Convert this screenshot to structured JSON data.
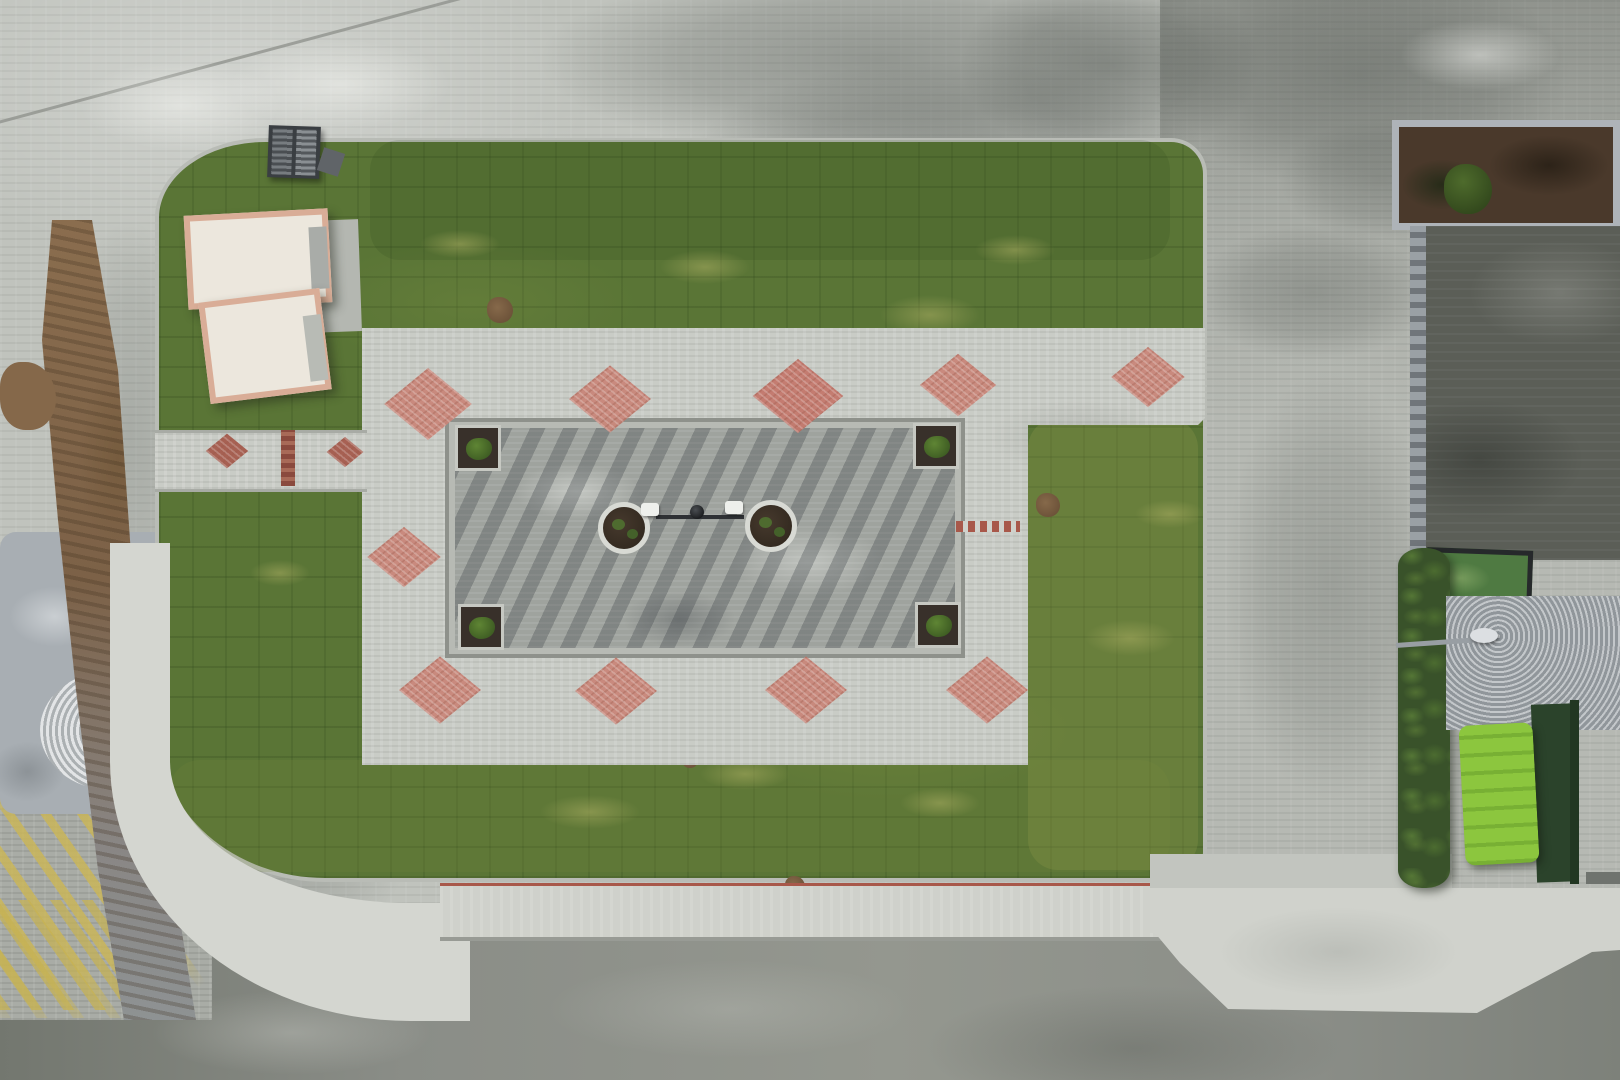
{
  "scene": {
    "type": "aerial-drone-photograph",
    "description": "Top-down drone view of a newly landscaped pocket park with a central outdoor fitness plaza, red exercise equipment, pink diamond paving accents, wooden benches, lawns of fresh sod, surrounding paver plazas, parked cars along three sides, a ramp with yellow arrows at top right, palm trees, a green utility container, and streets with sidewalks"
  },
  "palette": {
    "grass": "#5a7536",
    "pavement": "#c0c3bd",
    "plaza": "#c9ccc6",
    "fitness_pavement": "#9fa39e",
    "asphalt": "#8b8e88",
    "sidewalk": "#d4d6d0",
    "accent_red": "#a8584a",
    "diamond_pink": "#c98578",
    "equipment_red": "#e8472e",
    "bench_wood": "#b5762f",
    "hedge_green": "#39522a",
    "container_green": "#8cc63e",
    "tactile_yellow": "#cbb655",
    "mud_brown": "#8a6d4e",
    "ramp_yellow": "#c8b33e"
  },
  "objects": {
    "cars": [
      {
        "name": "car-top-silver-roof",
        "x": 681,
        "y": 97,
        "w": 108,
        "h": 55,
        "rot": -2,
        "o": "h",
        "body": "#3c4046",
        "glass": "#1e2125",
        "roof": "#c3c8cc"
      },
      {
        "name": "car-top-red",
        "x": 814,
        "y": 88,
        "w": 102,
        "h": 62,
        "rot": 2,
        "o": "h",
        "body": "#c0182a",
        "glass": "#26222e",
        "roof": null
      },
      {
        "name": "car-top-black",
        "x": 933,
        "y": 92,
        "w": 108,
        "h": 60,
        "rot": 1,
        "o": "h",
        "body": "#1a1d21",
        "glass": "#0e1013",
        "roof": "#2e3237"
      },
      {
        "name": "suv-top-right-white",
        "x": 1428,
        "y": 94,
        "w": 120,
        "h": 62,
        "rot": -1,
        "o": "h",
        "body": "#e9ebe9",
        "glass": "#2a2d33",
        "roof": "#c9cdd1"
      },
      {
        "name": "car-east-black",
        "x": 1206,
        "y": 186,
        "w": 62,
        "h": 116,
        "rot": 2,
        "o": "v",
        "body": "#1b1e22",
        "glass": "#0f1114",
        "roof": "#878d94"
      },
      {
        "name": "car-east-white-1",
        "x": 1209,
        "y": 451,
        "w": 60,
        "h": 114,
        "rot": 1,
        "o": "v",
        "body": "#e7e9e7",
        "glass": "#30343a",
        "roof": null
      },
      {
        "name": "car-east-darkblue",
        "x": 1206,
        "y": 586,
        "w": 64,
        "h": 125,
        "rot": 1,
        "o": "v",
        "body": "#27334e",
        "glass": "#12161f",
        "roof": "#3c4a68"
      },
      {
        "name": "car-east-maroon",
        "x": 1348,
        "y": 602,
        "w": 62,
        "h": 120,
        "rot": -2,
        "o": "v",
        "body": "#8e1e2c",
        "glass": "#1a161c",
        "roof": null
      },
      {
        "name": "car-east-white-2",
        "x": 1217,
        "y": 732,
        "w": 58,
        "h": 124,
        "rot": 2,
        "o": "v",
        "body": "#e8eae8",
        "glass": "#2e3237",
        "roof": null
      },
      {
        "name": "car-east-white-3",
        "x": 1363,
        "y": 744,
        "w": 63,
        "h": 120,
        "rot": -1,
        "o": "v",
        "body": "#eceeec",
        "glass": "#2b2f34",
        "roof": null
      },
      {
        "name": "car-south-white-1",
        "x": 447,
        "y": 963,
        "w": 128,
        "h": 62,
        "rot": -7,
        "o": "h",
        "body": "#e9ebe9",
        "glass": "#2c3036",
        "roof": null
      },
      {
        "name": "car-south-black",
        "x": 588,
        "y": 953,
        "w": 132,
        "h": 66,
        "rot": -2,
        "o": "h",
        "body": "#15171b",
        "glass": "#090a0c",
        "roof": null
      },
      {
        "name": "car-south-silver",
        "x": 856,
        "y": 940,
        "w": 132,
        "h": 62,
        "rot": -1,
        "o": "h",
        "body": "#dfe3e2",
        "glass": "#23272c",
        "roof": null
      },
      {
        "name": "car-south-white-2",
        "x": 1012,
        "y": 935,
        "w": 124,
        "h": 62,
        "rot": 1,
        "o": "h",
        "body": "#e9ebe9",
        "glass": "#272b30",
        "roof": null
      }
    ],
    "trees": [
      {
        "x": 349,
        "y": 161,
        "r": 23,
        "tone": "mid"
      },
      {
        "x": 303,
        "y": 152,
        "r": 11,
        "tone": "mid"
      },
      {
        "x": 718,
        "y": 182,
        "r": 28,
        "tone": "mid"
      },
      {
        "x": 757,
        "y": 198,
        "r": 14,
        "tone": "mid"
      },
      {
        "x": 1083,
        "y": 197,
        "r": 32,
        "tone": "mid"
      },
      {
        "x": 1120,
        "y": 228,
        "r": 16,
        "tone": "dark"
      },
      {
        "x": 1164,
        "y": 270,
        "r": 40,
        "tone": "dark"
      },
      {
        "x": 1146,
        "y": 315,
        "r": 22,
        "tone": "dark"
      },
      {
        "x": 1068,
        "y": 512,
        "r": 22,
        "tone": "bright"
      },
      {
        "x": 1225,
        "y": 668,
        "r": 26,
        "tone": "mid"
      },
      {
        "x": 270,
        "y": 838,
        "r": 22,
        "tone": "mid"
      },
      {
        "x": 350,
        "y": 846,
        "r": 20,
        "tone": "mid"
      },
      {
        "x": 298,
        "y": 898,
        "r": 20,
        "tone": "mid"
      },
      {
        "x": 388,
        "y": 903,
        "r": 16,
        "tone": "mid"
      },
      {
        "x": 518,
        "y": 897,
        "r": 24,
        "tone": "mid"
      },
      {
        "x": 566,
        "y": 890,
        "r": 13,
        "tone": "bright"
      },
      {
        "x": 786,
        "y": 901,
        "r": 23,
        "tone": "mid"
      },
      {
        "x": 1000,
        "y": 907,
        "r": 28,
        "tone": "mid"
      },
      {
        "x": 1048,
        "y": 917,
        "r": 16,
        "tone": "mid"
      },
      {
        "x": 1152,
        "y": 899,
        "r": 26,
        "tone": "mid"
      },
      {
        "x": 609,
        "y": 921,
        "r": 12,
        "tone": "bright"
      }
    ],
    "palms": [
      {
        "x": 1552,
        "y": 138,
        "r": 95
      },
      {
        "x": 1618,
        "y": 205,
        "r": 70
      },
      {
        "x": 1582,
        "y": 652,
        "r": 82
      },
      {
        "x": 1548,
        "y": 586,
        "r": 40
      }
    ],
    "bush_rows": [
      {
        "x1": 390,
        "y1": 172,
        "x2": 1165,
        "y2": 172,
        "count": 27,
        "r": 8
      },
      {
        "x1": 198,
        "y1": 860,
        "x2": 1135,
        "y2": 864,
        "count": 30,
        "r": 7
      },
      {
        "x1": 152,
        "y1": 565,
        "x2": 152,
        "y2": 845,
        "count": 8,
        "r": 6
      },
      {
        "x1": 185,
        "y1": 208,
        "x2": 330,
        "y2": 170,
        "count": 5,
        "r": 7
      },
      {
        "x1": 1185,
        "y1": 450,
        "x2": 1200,
        "y2": 580,
        "count": 5,
        "r": 6
      }
    ],
    "equipment": [
      {
        "type": "seats3",
        "x": 568,
        "y": 468
      },
      {
        "type": "walker",
        "x": 700,
        "y": 464
      },
      {
        "type": "rider",
        "x": 833,
        "y": 468
      },
      {
        "type": "chair",
        "x": 516,
        "y": 538
      },
      {
        "type": "spinner",
        "x": 915,
        "y": 539
      },
      {
        "type": "spinner",
        "x": 577,
        "y": 592
      },
      {
        "type": "ladder",
        "x": 706,
        "y": 586
      },
      {
        "type": "rider",
        "x": 837,
        "y": 585
      }
    ],
    "circle_planters": [
      {
        "x": 624,
        "y": 528
      },
      {
        "x": 771,
        "y": 526
      }
    ],
    "center_bar": {
      "x1": 656,
      "x2": 744,
      "y": 517,
      "pads": [
        {
          "x": 650,
          "y": 509
        },
        {
          "x": 734,
          "y": 507
        }
      ],
      "hub": {
        "x": 697,
        "y": 512
      }
    },
    "corner_planters": [
      {
        "x": 455,
        "y": 425
      },
      {
        "x": 913,
        "y": 423
      },
      {
        "x": 458,
        "y": 604
      },
      {
        "x": 915,
        "y": 602
      }
    ],
    "ball_lamps": [
      {
        "x": 370,
        "y": 363
      },
      {
        "x": 1009,
        "y": 345
      },
      {
        "x": 372,
        "y": 710
      },
      {
        "x": 1005,
        "y": 707
      }
    ],
    "benches": [
      {
        "x": 400,
        "y": 349
      },
      {
        "x": 512,
        "y": 361
      },
      {
        "x": 704,
        "y": 361
      },
      {
        "x": 876,
        "y": 357
      },
      {
        "x": 528,
        "y": 728
      },
      {
        "x": 713,
        "y": 728
      },
      {
        "x": 895,
        "y": 726
      }
    ],
    "diamonds": [
      {
        "x": 428,
        "y": 404,
        "s": 62
      },
      {
        "x": 610,
        "y": 399,
        "s": 58
      },
      {
        "x": 798,
        "y": 396,
        "s": 64,
        "solid": true
      },
      {
        "x": 958,
        "y": 385,
        "s": 54
      },
      {
        "x": 1148,
        "y": 377,
        "s": 52
      },
      {
        "x": 404,
        "y": 557,
        "s": 52
      },
      {
        "x": 440,
        "y": 690,
        "s": 58
      },
      {
        "x": 616,
        "y": 691,
        "s": 58
      },
      {
        "x": 806,
        "y": 690,
        "s": 58
      },
      {
        "x": 987,
        "y": 690,
        "s": 58
      },
      {
        "x": 227,
        "y": 451,
        "s": 30,
        "dark": true
      },
      {
        "x": 345,
        "y": 452,
        "s": 26,
        "dark": true
      }
    ],
    "plaza_red_dashline": {
      "x": 956,
      "y": 521,
      "w": 64,
      "h": 11
    },
    "crosswalk_strips_south": {
      "y": 888,
      "w": 15,
      "h": 47,
      "xs": [
        487,
        569,
        658,
        743,
        827,
        914,
        996,
        1086
      ]
    },
    "apron_strips": [
      {
        "x": 240,
        "y": 905,
        "w": 16,
        "h": 100
      },
      {
        "x": 318,
        "y": 906,
        "w": 16,
        "h": 112
      },
      {
        "x": 400,
        "y": 903,
        "w": 16,
        "h": 104
      },
      {
        "x": 1459,
        "y": 891,
        "w": 13,
        "h": 120
      },
      {
        "x": 1538,
        "y": 891,
        "w": 13,
        "h": 108
      },
      {
        "x": 1602,
        "y": 891,
        "w": 13,
        "h": 60
      },
      {
        "x": 1150,
        "y": 891,
        "w": 12,
        "h": 60
      }
    ],
    "curve_bars": [
      {
        "x": 117,
        "y": 577,
        "rot": 2
      },
      {
        "x": 126,
        "y": 677,
        "rot": 8
      },
      {
        "x": 140,
        "y": 792,
        "rot": 10
      },
      {
        "x": 161,
        "y": 872,
        "rot": 26
      }
    ],
    "white_dash_rows": [
      {
        "x": 175,
        "y": 918,
        "w": 985
      },
      {
        "x": 1150,
        "y": 909,
        "w": 470
      }
    ],
    "manholes": [
      {
        "shape": "rect",
        "x": 532,
        "y": 52,
        "w": 22,
        "h": 34
      },
      {
        "shape": "ring",
        "x": 508,
        "y": 127,
        "r": 9
      },
      {
        "shape": "ring",
        "x": 1332,
        "y": 97,
        "r": 12
      },
      {
        "shape": "dot",
        "x": 1311,
        "y": 160,
        "r": 7
      },
      {
        "shape": "ring",
        "x": 1424,
        "y": 904,
        "r": 11
      },
      {
        "shape": "rectline",
        "x": 1190,
        "y": 920,
        "w": 22,
        "h": 16
      },
      {
        "shape": "rectdark",
        "x": 1384,
        "y": 970,
        "w": 22,
        "h": 20
      },
      {
        "shape": "rectline",
        "x": 199,
        "y": 939,
        "w": 20,
        "h": 17
      },
      {
        "shape": "dot",
        "x": 258,
        "y": 1046,
        "r": 9
      }
    ],
    "ring_stains": [
      {
        "x": 355,
        "y": 965,
        "r": 26
      },
      {
        "x": 1098,
        "y": 978,
        "r": 30
      }
    ],
    "shadow_lines": [
      {
        "x": 368,
        "y": 962,
        "h": 118
      },
      {
        "x": 92,
        "y": 878,
        "h": 132
      }
    ],
    "wet_patches": [
      {
        "x": 540,
        "y": -40,
        "w": 680,
        "h": 200,
        "o": 0.42
      },
      {
        "x": 690,
        "y": 60,
        "w": 520,
        "h": 210,
        "o": 0.38
      },
      {
        "x": 960,
        "y": -30,
        "w": 300,
        "h": 190,
        "o": 0.45
      },
      {
        "x": 1150,
        "y": -40,
        "w": 420,
        "h": 230,
        "o": 0.42
      },
      {
        "x": 320,
        "y": 225,
        "w": 310,
        "h": 115,
        "o": 0.28
      },
      {
        "x": 1195,
        "y": 225,
        "w": 235,
        "h": 135,
        "o": 0.32
      },
      {
        "x": 1225,
        "y": 370,
        "w": 210,
        "h": 430,
        "o": 0.26
      },
      {
        "x": 140,
        "y": 620,
        "w": 280,
        "h": 350,
        "o": 0.3
      },
      {
        "x": -40,
        "y": 1010,
        "w": 320,
        "h": 110,
        "o": 0.35
      },
      {
        "x": 600,
        "y": 150,
        "w": 280,
        "h": 100,
        "o": 0.22
      },
      {
        "x": 60,
        "y": 220,
        "w": 140,
        "h": 420,
        "o": 0.22
      },
      {
        "x": 1280,
        "y": 120,
        "w": 200,
        "h": 120,
        "o": 0.3
      }
    ],
    "dry_patches": [
      {
        "x": 230,
        "y": 40,
        "w": 220,
        "h": 90
      },
      {
        "x": 580,
        "y": 170,
        "w": 230,
        "h": 80
      },
      {
        "x": 1400,
        "y": 20,
        "w": 160,
        "h": 70
      },
      {
        "x": 80,
        "y": 60,
        "w": 200,
        "h": 90
      },
      {
        "x": 470,
        "y": 250,
        "w": 160,
        "h": 60
      }
    ],
    "grass_dry_blobs": [
      {
        "x": 660,
        "y": 250,
        "w": 90,
        "h": 34
      },
      {
        "x": 880,
        "y": 295,
        "w": 100,
        "h": 40
      },
      {
        "x": 1085,
        "y": 620,
        "w": 90,
        "h": 36
      },
      {
        "x": 540,
        "y": 795,
        "w": 100,
        "h": 34
      },
      {
        "x": 900,
        "y": 788,
        "w": 80,
        "h": 30
      },
      {
        "x": 250,
        "y": 560,
        "w": 60,
        "h": 26
      },
      {
        "x": 975,
        "y": 235,
        "w": 80,
        "h": 30
      },
      {
        "x": 700,
        "y": 758,
        "w": 90,
        "h": 32
      },
      {
        "x": 1135,
        "y": 500,
        "w": 70,
        "h": 28
      },
      {
        "x": 420,
        "y": 230,
        "w": 80,
        "h": 28
      }
    ],
    "dirt_spots": [
      {
        "x": 500,
        "y": 310,
        "r": 13
      },
      {
        "x": 1048,
        "y": 505,
        "r": 12
      },
      {
        "x": 795,
        "y": 886,
        "r": 10
      },
      {
        "x": 690,
        "y": 760,
        "r": 8
      }
    ],
    "people": [
      {
        "name": "pedestrian-west",
        "x": 66,
        "y": 542,
        "shirt": "#2f3c55",
        "pants": "#66739a"
      },
      {
        "name": "child-with-balloons-1",
        "x": 1307,
        "y": 262,
        "shirt": "#8a2430",
        "pants": "#5a4048"
      },
      {
        "name": "child-with-balloons-2",
        "x": 1317,
        "y": 252,
        "shirt": "#e8e4de",
        "pants": "#8a8a8a"
      }
    ],
    "balloons": [
      {
        "x": 1295,
        "y": 283,
        "r": 7,
        "c": "#e583b5"
      },
      {
        "x": 1324,
        "y": 270,
        "r": 6,
        "c": "#58c4e8"
      },
      {
        "x": 1301,
        "y": 294,
        "r": 5,
        "c": "#d8a0c0"
      }
    ],
    "small_marks": {
      "bollard": {
        "x": 786,
        "y": 908,
        "w": 7,
        "h": 24,
        "rot": 75
      },
      "blue_paint": {
        "x": 98,
        "y": 894,
        "w": 20,
        "h": 8,
        "rot": -15,
        "c": "#4a7ab8"
      },
      "bird": {
        "x": 1488,
        "y": 899,
        "w": 11,
        "h": 7
      },
      "ground_lights": [
        {
          "x": 285,
          "y": 345
        },
        {
          "x": 533,
          "y": 340
        }
      ]
    },
    "ramp_markings": {
      "lines_y": [
        292,
        452
      ],
      "double_arrow": {
        "x": 1462,
        "y": 238,
        "h": 56
      },
      "right_arrows": [
        {
          "x": 1448,
          "y": 314,
          "w": 76
        },
        {
          "x": 1450,
          "y": 476,
          "w": 70
        }
      ],
      "edge_patch": {
        "x": 1418,
        "y": 540,
        "w": 34,
        "h": 12
      },
      "fence_clamps": [
        {
          "x": 1428,
          "y": 352
        },
        {
          "x": 1428,
          "y": 518
        }
      ]
    },
    "container_details": {
      "panels": [
        {
          "x": 1490,
          "y": 766,
          "w": 26,
          "h": 56
        },
        {
          "x": 1514,
          "y": 786,
          "w": 26,
          "h": 60
        }
      ],
      "box": {
        "x": 1498,
        "y": 836,
        "w": 28,
        "h": 22
      },
      "sticker": {
        "x": 1468,
        "y": 786,
        "w": 8,
        "h": 14
      }
    },
    "se_bushes": [
      {
        "x": 1468,
        "y": 655,
        "r": 26
      },
      {
        "x": 1502,
        "y": 680,
        "r": 22
      },
      {
        "x": 1478,
        "y": 695,
        "r": 18
      },
      {
        "x": 1540,
        "y": 612,
        "r": 20
      }
    ],
    "grass_tints": [
      {
        "x": 1028,
        "y": 418,
        "w": 170,
        "h": 452,
        "c": "rgba(150,160,80,0.25)"
      },
      {
        "x": 170,
        "y": 760,
        "w": 1000,
        "h": 112,
        "c": "rgba(120,140,60,0.18)"
      },
      {
        "x": 370,
        "y": 140,
        "w": 800,
        "h": 120,
        "c": "rgba(40,70,25,0.15)"
      }
    ],
    "sheds": [
      {
        "name": "shed-large",
        "x": 186,
        "y": 212,
        "w": 144,
        "h": 94,
        "rot": -3
      },
      {
        "name": "shed-small",
        "x": 204,
        "y": 295,
        "w": 122,
        "h": 102,
        "rot": -7
      }
    ]
  }
}
